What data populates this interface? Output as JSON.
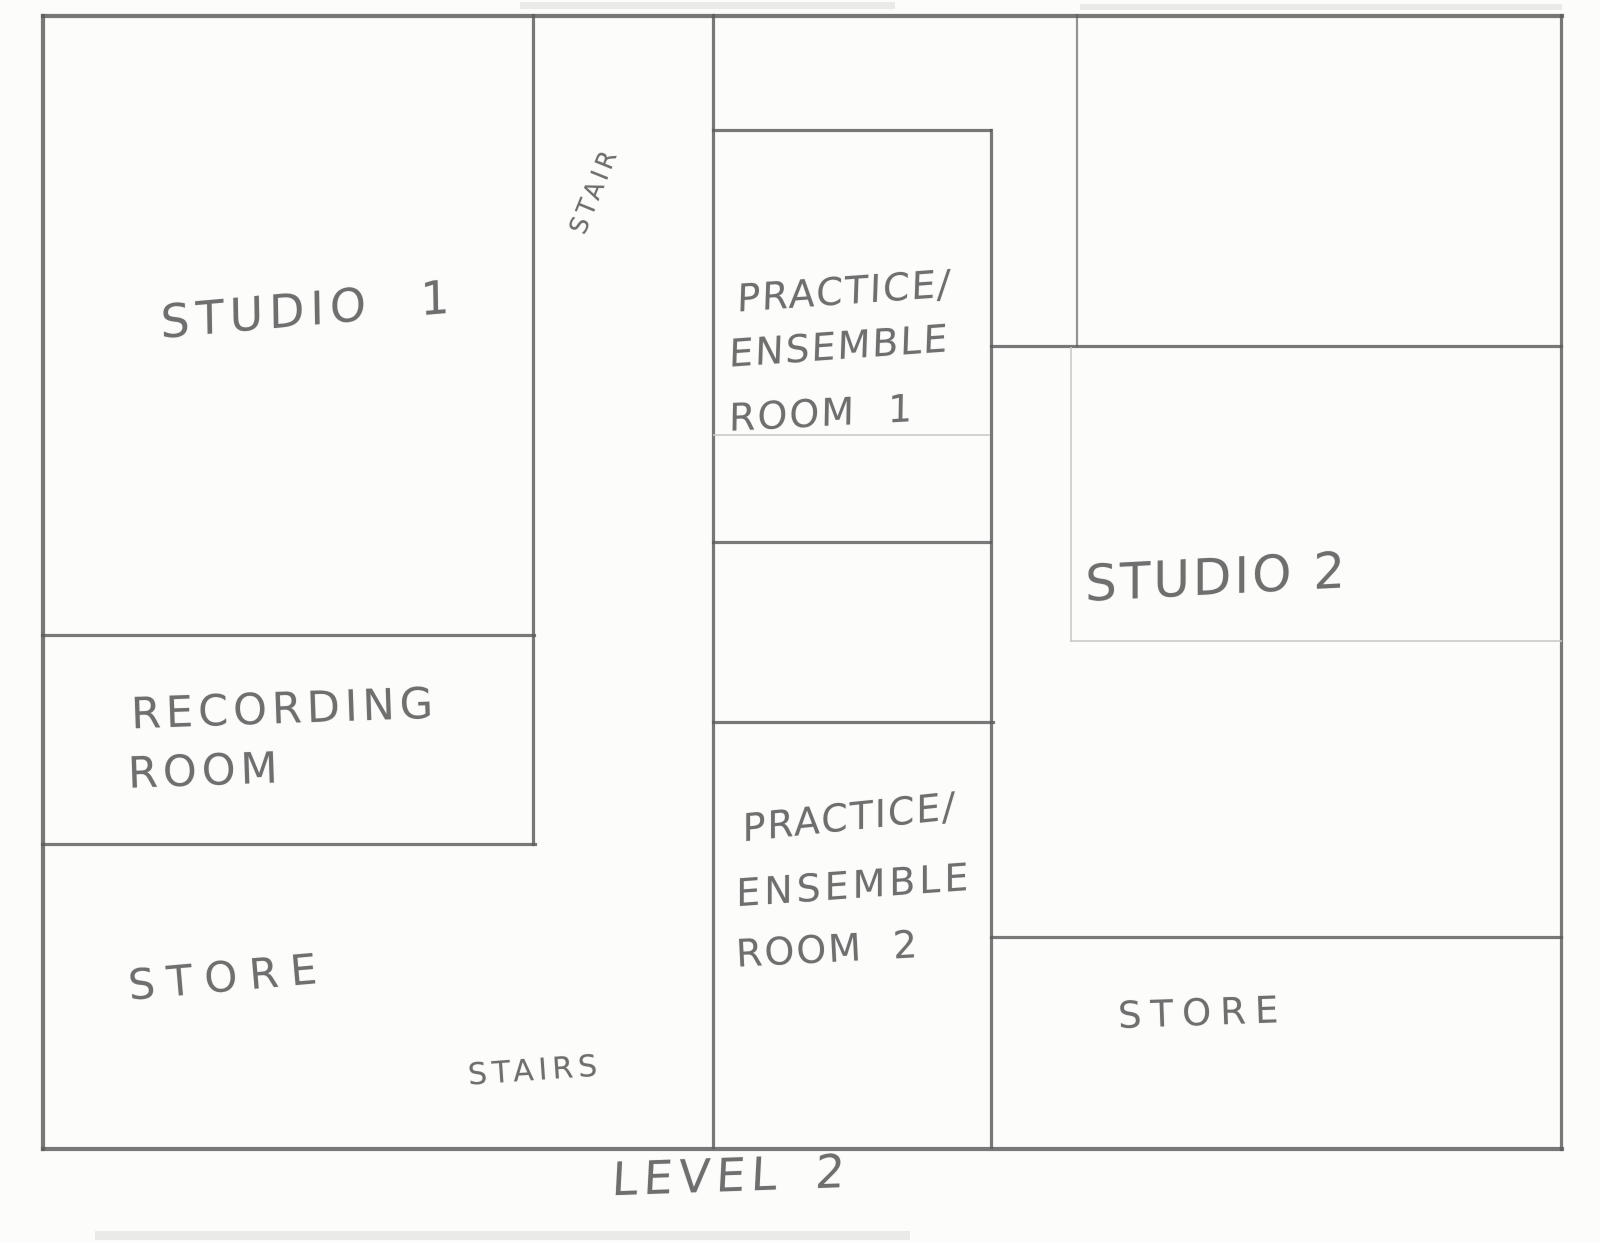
{
  "plan": {
    "caption": "LEVEL 2",
    "labels": {
      "studio1": "STUDIO 1",
      "stair_top": "STAIR",
      "practice1_line1": "PRACTICE/",
      "practice1_line2": "ENSEMBLE",
      "practice1_line3": "ROOM 1",
      "studio2": "STUDIO 2",
      "recording_line1": "RECORDING",
      "recording_line2": "ROOM",
      "store_left": "STORE",
      "stairs_bottom": "STAIRS",
      "practice2_line1": "PRACTICE/",
      "practice2_line2": "ENSEMBLE",
      "practice2_line3": "ROOM 2",
      "store_right": "STORE"
    },
    "colors": {
      "paper": "#fcfcfb",
      "pencil_dark": "#5c5c5c",
      "pencil_text": "#6f6f6f",
      "pencil_faint": "#c8c8c6"
    }
  }
}
